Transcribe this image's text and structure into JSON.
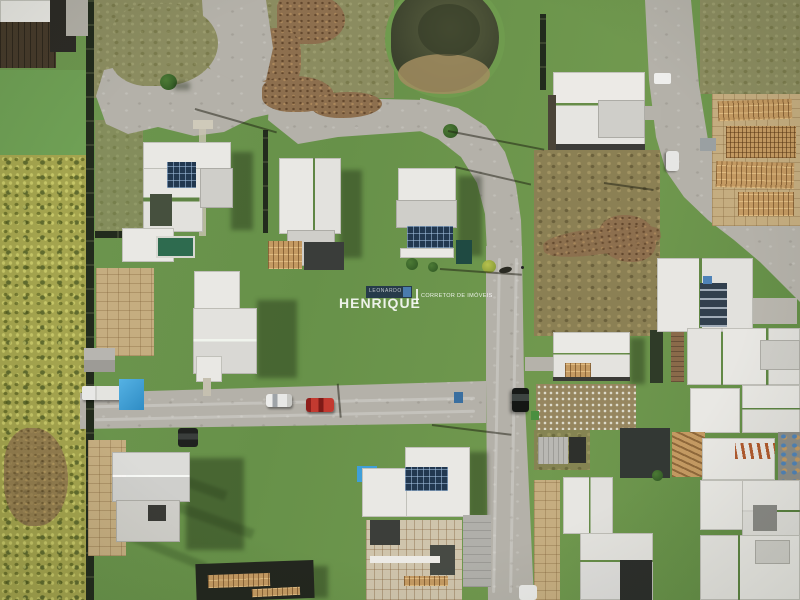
{
  "watermark": {
    "badge_text": "LEONARDO",
    "name": "HENRIQUE",
    "tagline": "CORRETOR DE IMÓVEIS"
  },
  "colors": {
    "grass": "#6f9752",
    "road": "#b4b1a9",
    "fence": "#222b1d",
    "roofWhite": "#e9e8e4",
    "roofGray": "#cfcec9",
    "roofDark": "#3a3c38",
    "wood": "#c49a62",
    "mulch": "#8d6f4e",
    "sand": "#c5ad80",
    "pond": "#4e5438",
    "pondMud": "#a28d60",
    "solar": "#223850",
    "pool": "#2e6b4f",
    "tarp": "#3f9fd8",
    "carRed": "#b83028",
    "wmNavy": "#1b2b4a",
    "wmBlue": "#4f83b8"
  }
}
